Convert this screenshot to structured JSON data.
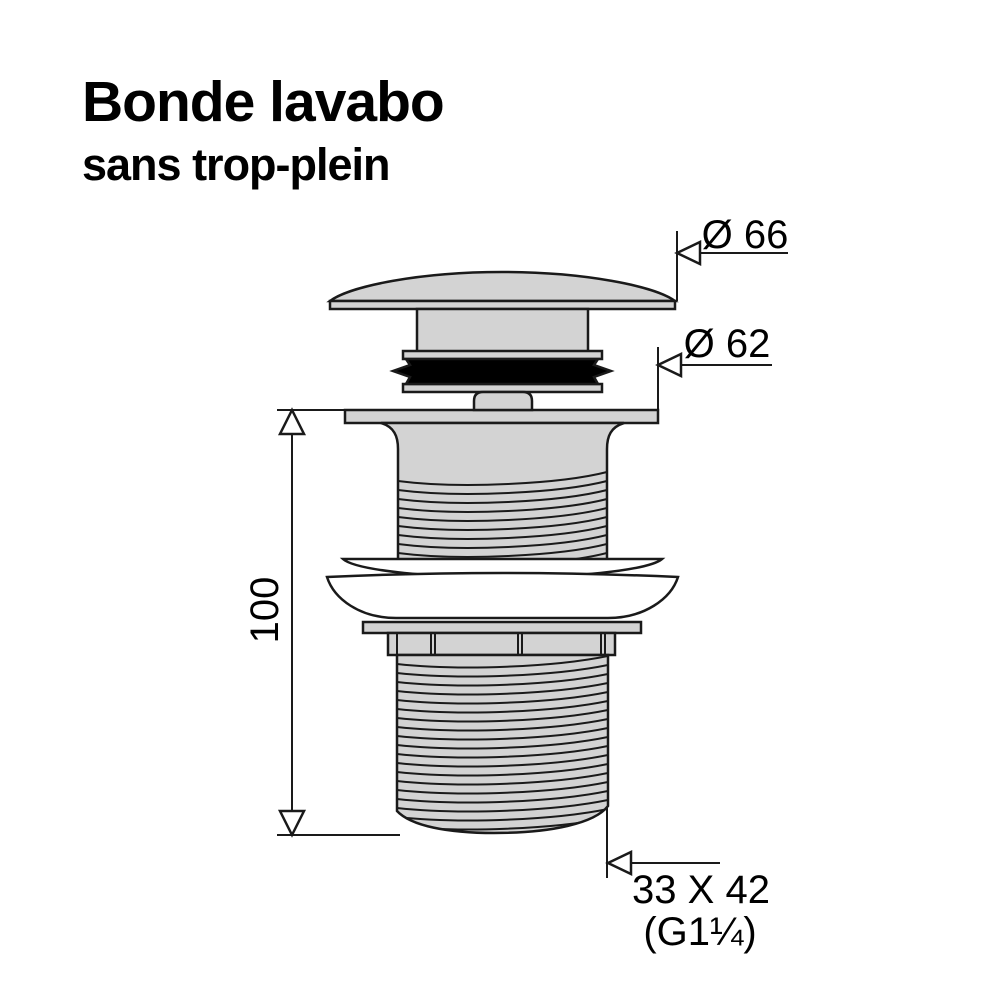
{
  "title": {
    "line1": "Bonde lavabo",
    "line2": "sans trop-plein"
  },
  "dimensions": {
    "cap_diameter_label": "Ø 66",
    "flange_diameter_label": "Ø 62",
    "height_label": "100",
    "thread_size_label": "33 X 42",
    "thread_standard_label": "(G1¼)"
  },
  "colors": {
    "part_fill": "#d3d3d3",
    "outline": "#1a1a1a",
    "gasket_fill": "#000000",
    "white_fill": "#ffffff",
    "text": "#000000",
    "background": "#ffffff"
  }
}
